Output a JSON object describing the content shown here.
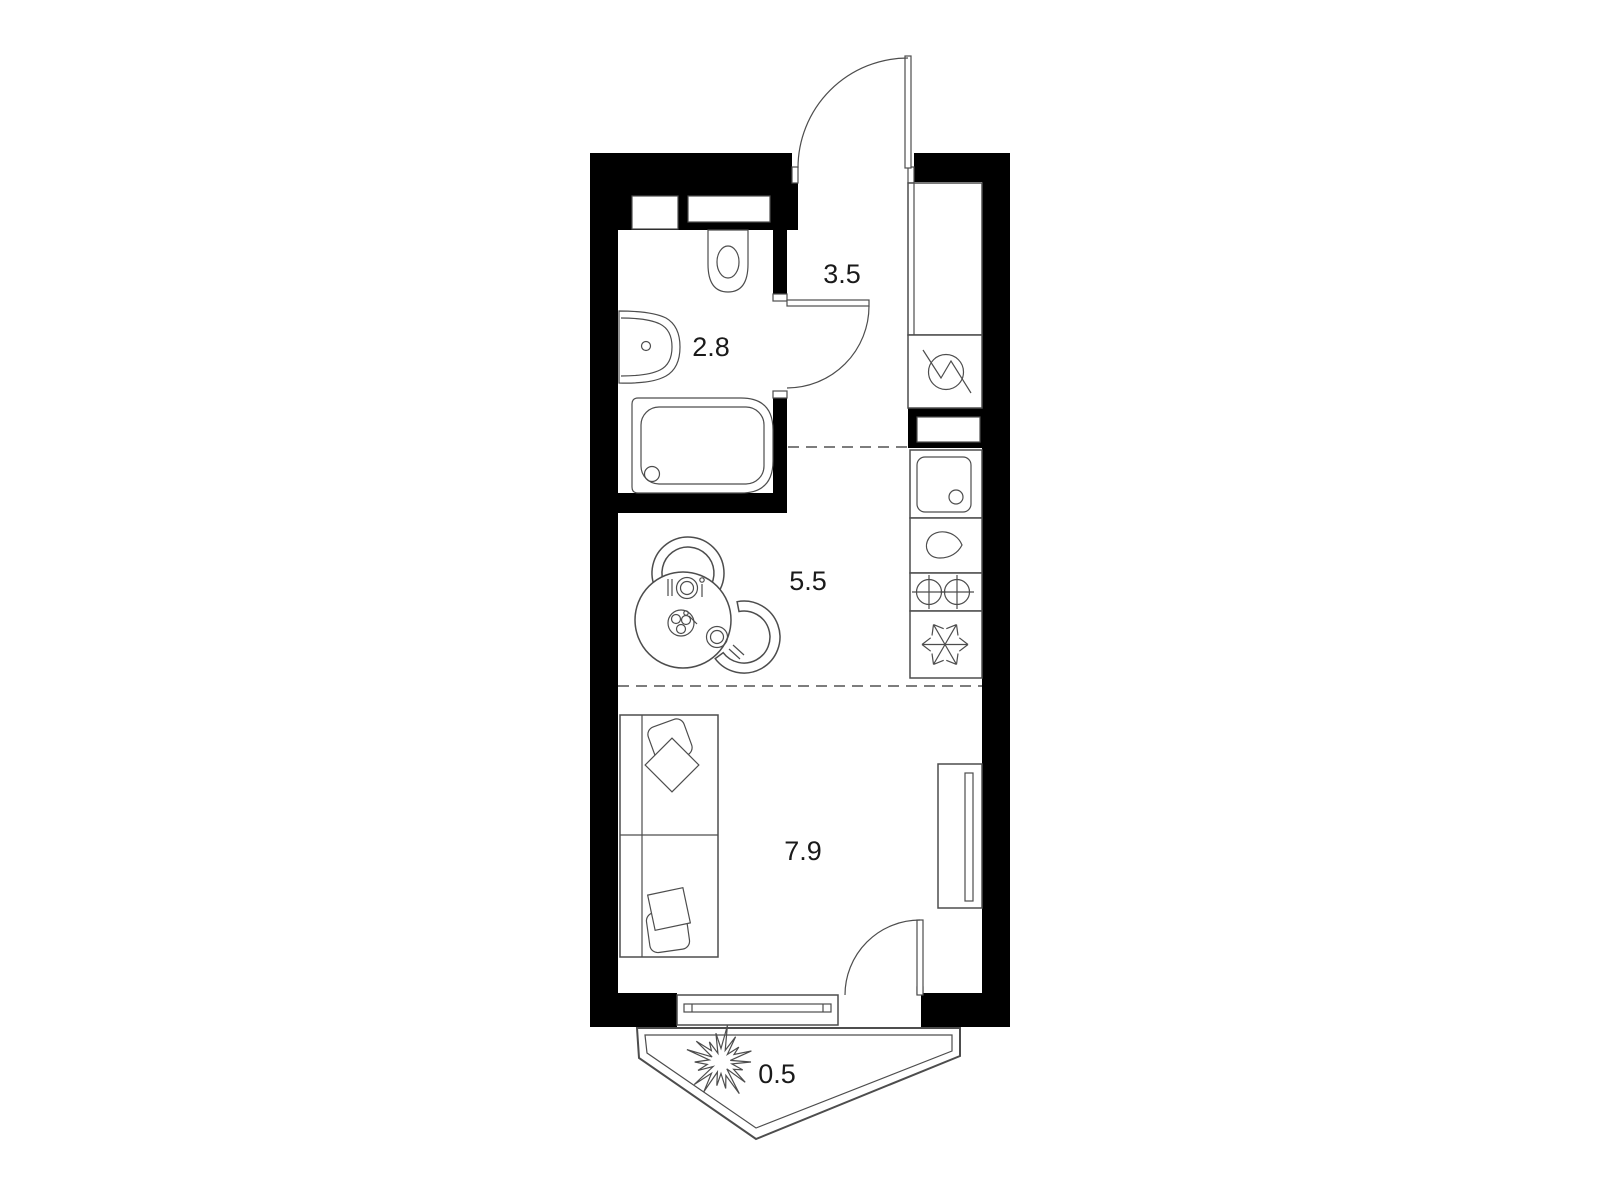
{
  "floorplan": {
    "rooms": {
      "hallway_area": "3.5",
      "bathroom_area": "2.8",
      "kitchen_area": "5.5",
      "living_room_area": "7.9",
      "balcony_area": "0.5"
    },
    "colors": {
      "wall": "#000000",
      "furniture_line": "#4d4d4d",
      "dash_line": "#7d7d7d",
      "label_text": "#1a1a1a",
      "background": "#ffffff"
    }
  }
}
